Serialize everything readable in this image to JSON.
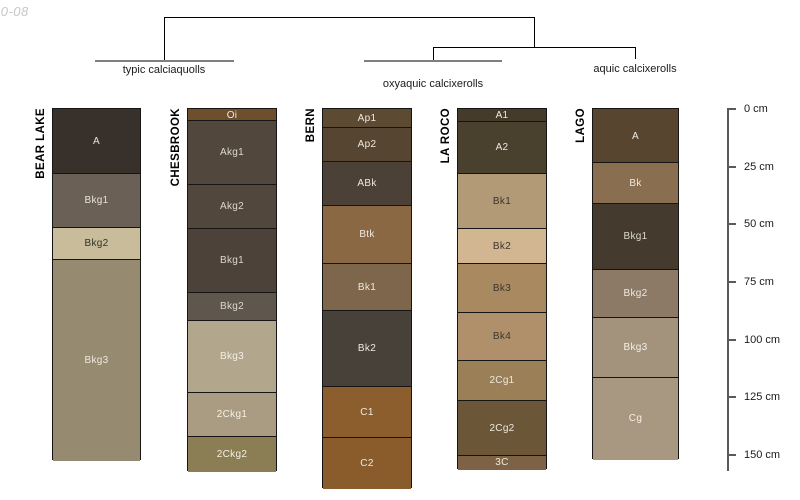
{
  "watermark": {
    "text": "10-08"
  },
  "dendrogram": {
    "line_color": "#000000",
    "group_bar_color": "#7f7f7f",
    "labels": [
      {
        "text": "typic calciaquolls",
        "x": 164,
        "y": 64
      },
      {
        "text": "oxyaquic calcixerolls",
        "x": 433,
        "y": 78
      },
      {
        "text": "aquic calcixerolls",
        "x": 635,
        "y": 63
      }
    ],
    "segments": [
      {
        "kind": "line",
        "x1": 164,
        "y1": 17,
        "x2": 534,
        "y2": 17
      },
      {
        "kind": "line",
        "x1": 164,
        "y1": 17,
        "x2": 164,
        "y2": 60
      },
      {
        "kind": "line",
        "x1": 534,
        "y1": 17,
        "x2": 534,
        "y2": 47
      },
      {
        "kind": "line",
        "x1": 433,
        "y1": 47,
        "x2": 635,
        "y2": 47
      },
      {
        "kind": "line",
        "x1": 433,
        "y1": 47,
        "x2": 433,
        "y2": 60
      },
      {
        "kind": "line",
        "x1": 635,
        "y1": 47,
        "x2": 635,
        "y2": 59
      },
      {
        "kind": "bar",
        "x1": 95,
        "y1": 60,
        "x2": 234,
        "y2": 60
      },
      {
        "kind": "bar",
        "x1": 364,
        "y1": 60,
        "x2": 502,
        "y2": 60
      }
    ]
  },
  "depth_axis": {
    "x": 727,
    "top": 109,
    "bottom": 471,
    "label_x": 744,
    "ticks": [
      {
        "label": "0 cm",
        "y": 109
      },
      {
        "label": "25 cm",
        "y": 167
      },
      {
        "label": "50 cm",
        "y": 224
      },
      {
        "label": "75 cm",
        "y": 282
      },
      {
        "label": "100 cm",
        "y": 340
      },
      {
        "label": "125 cm",
        "y": 397
      },
      {
        "label": "150 cm",
        "y": 455
      }
    ]
  },
  "profiles": [
    {
      "name": "BEAR LAKE",
      "x": 52,
      "width": 89,
      "top": 108,
      "horizons": [
        {
          "name": "A",
          "top": 108,
          "bottom": 173,
          "color": "#38302a",
          "text": "#e8e3da"
        },
        {
          "name": "Bkg1",
          "top": 173,
          "bottom": 227,
          "color": "#6a6055",
          "text": "#e8e3da"
        },
        {
          "name": "Bkg2",
          "top": 227,
          "bottom": 259,
          "color": "#c9bc9b",
          "text": "#30302e"
        },
        {
          "name": "Bkg3",
          "top": 259,
          "bottom": 460,
          "color": "#968a70",
          "text": "#eee9e0"
        }
      ]
    },
    {
      "name": "CHESBROOK",
      "x": 187,
      "width": 90,
      "top": 108,
      "horizons": [
        {
          "name": "Oi",
          "top": 108,
          "bottom": 120,
          "color": "#6d4f2c",
          "text": "#efeae1"
        },
        {
          "name": "Akg1",
          "top": 120,
          "bottom": 184,
          "color": "#52473d",
          "text": "#ddd8cf"
        },
        {
          "name": "Akg2",
          "top": 184,
          "bottom": 228,
          "color": "#52473d",
          "text": "#ddd8cf"
        },
        {
          "name": "Bkg1",
          "top": 228,
          "bottom": 292,
          "color": "#4c423a",
          "text": "#ddd8cf"
        },
        {
          "name": "Bkg2",
          "top": 292,
          "bottom": 320,
          "color": "#5f574d",
          "text": "#ddd8cf"
        },
        {
          "name": "Bkg3",
          "top": 320,
          "bottom": 392,
          "color": "#b2a68c",
          "text": "#f4efe6"
        },
        {
          "name": "2Ckg1",
          "top": 392,
          "bottom": 436,
          "color": "#a99c82",
          "text": "#f4efe6"
        },
        {
          "name": "2Ckg2",
          "top": 436,
          "bottom": 471,
          "color": "#8b7d54",
          "text": "#f4efe6"
        }
      ]
    },
    {
      "name": "BERN",
      "x": 322,
      "width": 90,
      "top": 108,
      "horizons": [
        {
          "name": "Ap1",
          "top": 108,
          "bottom": 127,
          "color": "#5d4a33",
          "text": "#eee9e0"
        },
        {
          "name": "Ap2",
          "top": 127,
          "bottom": 161,
          "color": "#564531",
          "text": "#eee9e0"
        },
        {
          "name": "ABk",
          "top": 161,
          "bottom": 205,
          "color": "#4c4136",
          "text": "#eee9e0"
        },
        {
          "name": "Btk",
          "top": 205,
          "bottom": 263,
          "color": "#8a6844",
          "text": "#eee9e0"
        },
        {
          "name": "Bk1",
          "top": 263,
          "bottom": 310,
          "color": "#7d664b",
          "text": "#eee9e0"
        },
        {
          "name": "Bk2",
          "top": 310,
          "bottom": 386,
          "color": "#48413a",
          "text": "#eee9e0"
        },
        {
          "name": "C1",
          "top": 386,
          "bottom": 437,
          "color": "#8c5e2e",
          "text": "#eee9e0"
        },
        {
          "name": "C2",
          "top": 437,
          "bottom": 488,
          "color": "#8a5c2c",
          "text": "#eee9e0"
        }
      ]
    },
    {
      "name": "LA ROCO",
      "x": 457,
      "width": 90,
      "top": 108,
      "horizons": [
        {
          "name": "A1",
          "top": 108,
          "bottom": 121,
          "color": "#453b2b",
          "text": "#eee9e0"
        },
        {
          "name": "A2",
          "top": 121,
          "bottom": 173,
          "color": "#4a402e",
          "text": "#eee9e0"
        },
        {
          "name": "Bk1",
          "top": 173,
          "bottom": 228,
          "color": "#b29a77",
          "text": "#3a362f"
        },
        {
          "name": "Bk2",
          "top": 228,
          "bottom": 263,
          "color": "#d1b691",
          "text": "#3a362f"
        },
        {
          "name": "Bk3",
          "top": 263,
          "bottom": 312,
          "color": "#a98a60",
          "text": "#3a362f"
        },
        {
          "name": "Bk4",
          "top": 312,
          "bottom": 360,
          "color": "#b0906a",
          "text": "#3a362f"
        },
        {
          "name": "2Cg1",
          "top": 360,
          "bottom": 400,
          "color": "#9b7f56",
          "text": "#eee9e0"
        },
        {
          "name": "2Cg2",
          "top": 400,
          "bottom": 455,
          "color": "#6b5638",
          "text": "#eee9e0"
        },
        {
          "name": "3C",
          "top": 455,
          "bottom": 469,
          "color": "#7d6245",
          "text": "#eee9e0"
        }
      ]
    },
    {
      "name": "LAGO",
      "x": 592,
      "width": 87,
      "top": 108,
      "horizons": [
        {
          "name": "A",
          "top": 108,
          "bottom": 162,
          "color": "#57452f",
          "text": "#eee9e0"
        },
        {
          "name": "Bk",
          "top": 162,
          "bottom": 203,
          "color": "#8a6e50",
          "text": "#eee9e0"
        },
        {
          "name": "Bkg1",
          "top": 203,
          "bottom": 269,
          "color": "#443a2d",
          "text": "#ddd8cf"
        },
        {
          "name": "Bkg2",
          "top": 269,
          "bottom": 317,
          "color": "#8c7a66",
          "text": "#eee9e0"
        },
        {
          "name": "Bkg3",
          "top": 317,
          "bottom": 377,
          "color": "#a3927c",
          "text": "#f4efe6"
        },
        {
          "name": "Cg",
          "top": 377,
          "bottom": 459,
          "color": "#a89881",
          "text": "#f4efe6"
        }
      ]
    }
  ],
  "marker": {
    "shape": "triangle-up",
    "fill": "#e81c1c",
    "stroke": "#801010",
    "center_x": 501,
    "apex_y": 472,
    "base_y": 489,
    "half_width": 9
  },
  "chart_data": {
    "type": "table",
    "title": "Soil profile sketches with dendrogram grouping by taxonomic subgroup",
    "ylabel": "Depth (cm)",
    "depth_scale_cm": [
      0,
      25,
      50,
      75,
      100,
      125,
      150
    ],
    "groups": [
      {
        "label": "typic calciaquolls",
        "profiles": [
          "BEAR LAKE",
          "CHESBROOK"
        ]
      },
      {
        "label": "oxyaquic calcixerolls",
        "profiles": [
          "BERN",
          "LA ROCO"
        ]
      },
      {
        "label": "aquic calcixerolls",
        "profiles": [
          "LAGO"
        ]
      }
    ],
    "profiles": [
      {
        "id": "BEAR LAKE",
        "horizons": [
          {
            "name": "A",
            "top_cm": 0,
            "bottom_cm": 28
          },
          {
            "name": "Bkg1",
            "top_cm": 28,
            "bottom_cm": 51
          },
          {
            "name": "Bkg2",
            "top_cm": 51,
            "bottom_cm": 65
          },
          {
            "name": "Bkg3",
            "top_cm": 65,
            "bottom_cm": 152
          }
        ]
      },
      {
        "id": "CHESBROOK",
        "horizons": [
          {
            "name": "Oi",
            "top_cm": 0,
            "bottom_cm": 5
          },
          {
            "name": "Akg1",
            "top_cm": 5,
            "bottom_cm": 33
          },
          {
            "name": "Akg2",
            "top_cm": 33,
            "bottom_cm": 52
          },
          {
            "name": "Bkg1",
            "top_cm": 52,
            "bottom_cm": 79
          },
          {
            "name": "Bkg2",
            "top_cm": 79,
            "bottom_cm": 92
          },
          {
            "name": "Bkg3",
            "top_cm": 92,
            "bottom_cm": 123
          },
          {
            "name": "2Ckg1",
            "top_cm": 123,
            "bottom_cm": 142
          },
          {
            "name": "2Ckg2",
            "top_cm": 142,
            "bottom_cm": 157
          }
        ]
      },
      {
        "id": "BERN",
        "horizons": [
          {
            "name": "Ap1",
            "top_cm": 0,
            "bottom_cm": 8
          },
          {
            "name": "Ap2",
            "top_cm": 8,
            "bottom_cm": 23
          },
          {
            "name": "ABk",
            "top_cm": 23,
            "bottom_cm": 42
          },
          {
            "name": "Btk",
            "top_cm": 42,
            "bottom_cm": 67
          },
          {
            "name": "Bk1",
            "top_cm": 67,
            "bottom_cm": 87
          },
          {
            "name": "Bk2",
            "top_cm": 87,
            "bottom_cm": 120
          },
          {
            "name": "C1",
            "top_cm": 120,
            "bottom_cm": 142
          },
          {
            "name": "C2",
            "top_cm": 142,
            "bottom_cm": 164
          }
        ]
      },
      {
        "id": "LA ROCO",
        "marker": "red triangle below profile base",
        "horizons": [
          {
            "name": "A1",
            "top_cm": 0,
            "bottom_cm": 5
          },
          {
            "name": "A2",
            "top_cm": 5,
            "bottom_cm": 28
          },
          {
            "name": "Bk1",
            "top_cm": 28,
            "bottom_cm": 52
          },
          {
            "name": "Bk2",
            "top_cm": 52,
            "bottom_cm": 67
          },
          {
            "name": "Bk3",
            "top_cm": 67,
            "bottom_cm": 88
          },
          {
            "name": "Bk4",
            "top_cm": 88,
            "bottom_cm": 109
          },
          {
            "name": "2Cg1",
            "top_cm": 109,
            "bottom_cm": 126
          },
          {
            "name": "2Cg2",
            "top_cm": 126,
            "bottom_cm": 150
          },
          {
            "name": "3C",
            "top_cm": 150,
            "bottom_cm": 156
          }
        ]
      },
      {
        "id": "LAGO",
        "horizons": [
          {
            "name": "A",
            "top_cm": 0,
            "bottom_cm": 23
          },
          {
            "name": "Bk",
            "top_cm": 23,
            "bottom_cm": 41
          },
          {
            "name": "Bkg1",
            "top_cm": 41,
            "bottom_cm": 69
          },
          {
            "name": "Bkg2",
            "top_cm": 69,
            "bottom_cm": 90
          },
          {
            "name": "Bkg3",
            "top_cm": 90,
            "bottom_cm": 116
          },
          {
            "name": "Cg",
            "top_cm": 116,
            "bottom_cm": 152
          }
        ]
      }
    ]
  }
}
